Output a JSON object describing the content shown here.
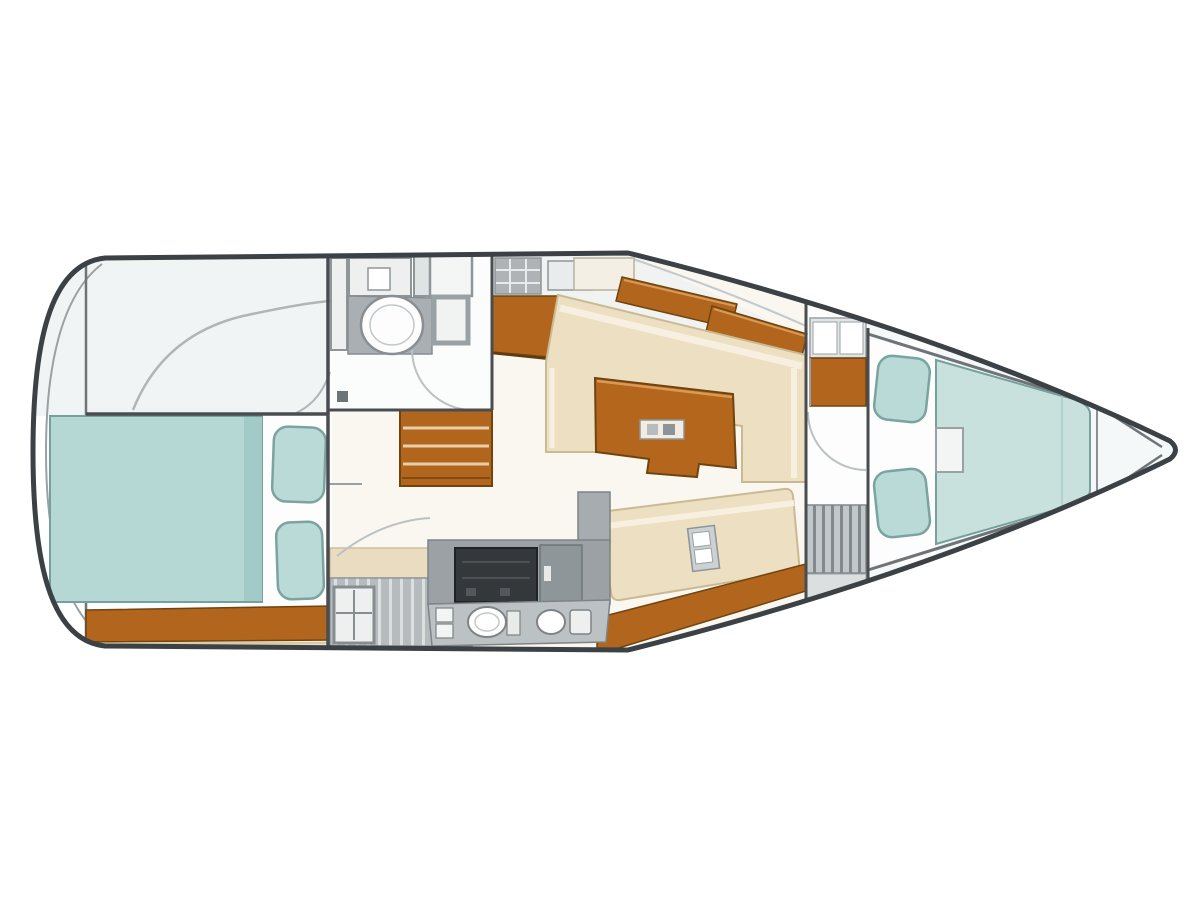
{
  "diagram": {
    "kind": "sailboat-interior-floor-plan",
    "regions": {
      "aft_deck": "aft deck",
      "aft_cabin": "aft double cabin",
      "head": "head bathroom",
      "companionway": "companionway steps",
      "saloon": "saloon settee and table",
      "galley": "galley",
      "passage": "passage wardrobe",
      "forward_cabin": "forward v-berth cabin",
      "anchor_locker": "anchor locker"
    }
  },
  "palette": {
    "background": "#ffffff",
    "hull_outline": "#3c4145",
    "hull_fill": "#ffffff",
    "wall": "#494d50",
    "liner": "#6e7477",
    "frame_gray": "#8f969a",
    "detail_line": "#b9bfc1",
    "floor_aft_deck": "#f1f4f4",
    "floor_cabin_white": "#fdfdfd",
    "floor_salon": "#faf7f0",
    "floor_head": "#fbfcfc",
    "floor_forward": "#f4f8f8",
    "berth_teal": "#b5d8d4",
    "berth_shade": "#a2cbc7",
    "berth_edge": "#76a09d",
    "fwd_berth": "#c9e1dd",
    "pillow_teal": "#b9dad6",
    "pillow_edge": "#7ba4a1",
    "wood_brown": "#b2651d",
    "wood_dark": "#6f4410",
    "wood_light": "#d89a55",
    "wood_table": "#b4661d",
    "cream_settee": "#ecdfc2",
    "cream_light": "#f7f0e0",
    "cream_edge": "#c9ba94",
    "beige_counter": "#e9dcc0",
    "counter_gray": "#a9afb2",
    "appliance_gray": "#9ba1a4",
    "cabinet_gray": "#b6bbbe",
    "stove_black": "#34383b",
    "latch_gray": "#ccd1d3",
    "white": "#ffffff"
  }
}
